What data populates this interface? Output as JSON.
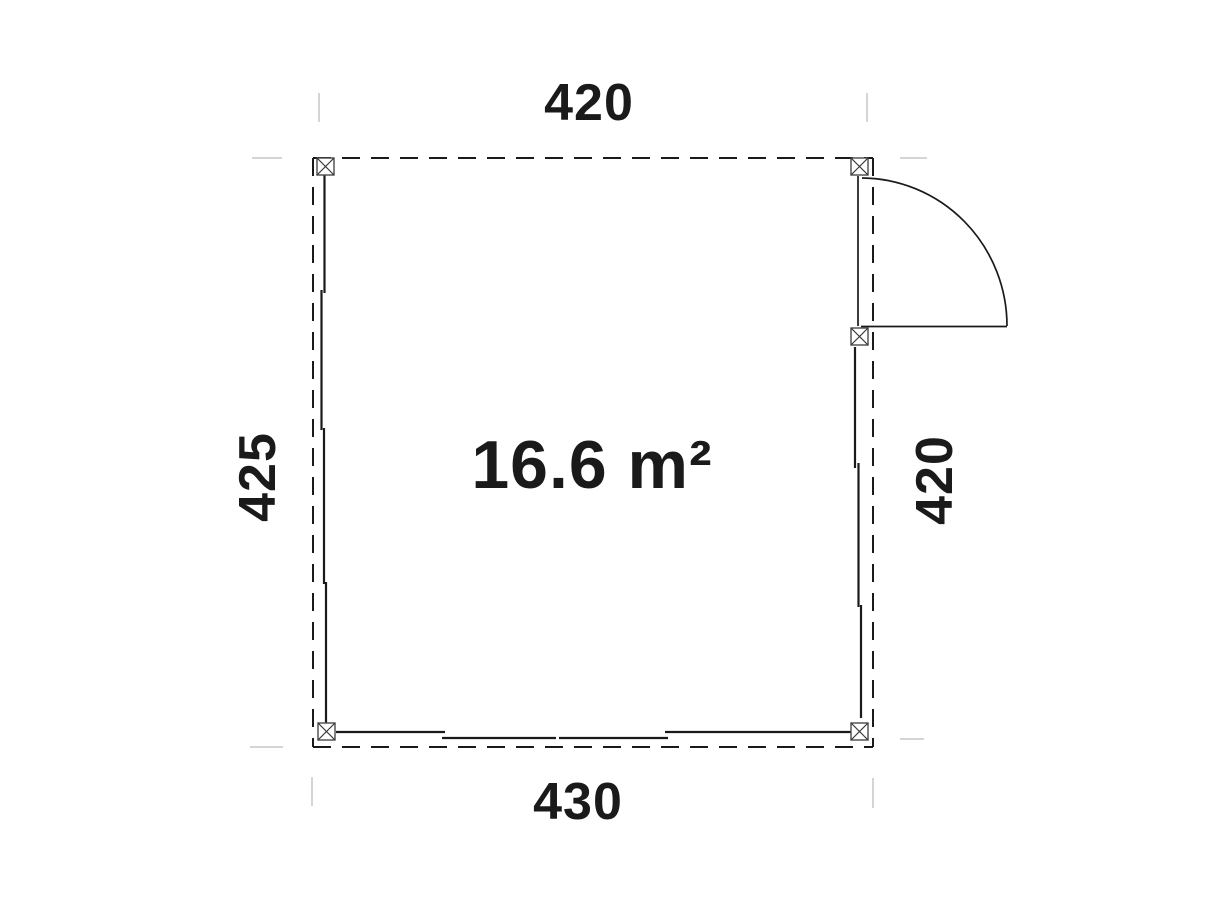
{
  "plan": {
    "area_label": "16.6 m²",
    "dim_top": "420",
    "dim_bottom": "430",
    "dim_left": "425",
    "dim_right": "420"
  },
  "colors": {
    "line": "#1a1a1a",
    "tick": "#d5d5d5",
    "background": "#ffffff"
  }
}
